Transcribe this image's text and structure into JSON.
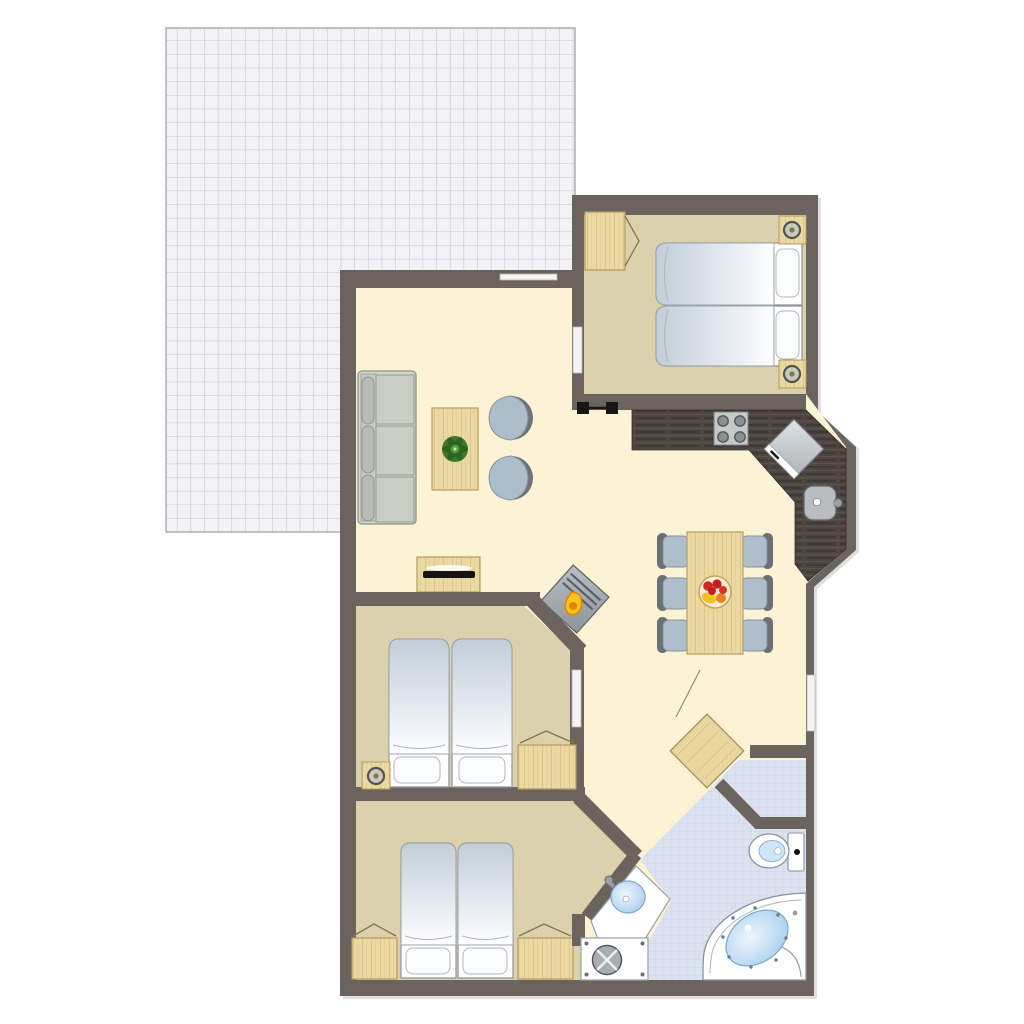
{
  "title": "Holiday apartment floor plan with terrace, three bedrooms, open living-dining-kitchen and bathroom",
  "palette": {
    "wall": "#6b635d",
    "floor_living": "#fcf2d4",
    "floor_bedroom": "#dcd1ad",
    "floor_bathroom": "#dbe3f1",
    "terrace_tile": "#f3f3f5",
    "terrace_grid": "#c2c2c9",
    "light_wood": "#ebd9a3",
    "counter_dark": "#4c4440",
    "water_blue": "#bcd9f1",
    "upholstery_gray": "#cbcec6",
    "chair_blue_gray": "#b0bfcc",
    "chair_back_gray": "#6b7075",
    "appliance_gray": "#c8ccd0",
    "flame_yellow": "#f6c41a",
    "flame_orange": "#e5830f",
    "plant_green": "#3c7a2b",
    "fruit_red": "#d02820",
    "fruit_orange": "#e8821e",
    "door_symbol_black": "#161616"
  },
  "rooms": [
    {
      "id": "terrace",
      "name": "tiled terrace",
      "floor": "gray tile grid"
    },
    {
      "id": "living-room",
      "name": "living room",
      "floor": "cream"
    },
    {
      "id": "dining-area",
      "name": "dining area",
      "floor": "cream"
    },
    {
      "id": "kitchen",
      "name": "kitchen corner with angled counter",
      "floor": "cream"
    },
    {
      "id": "bedroom-master",
      "name": "bedroom top-right (double bed)",
      "floor": "beige"
    },
    {
      "id": "bedroom-middle",
      "name": "bedroom middle-left (double bed)",
      "floor": "beige"
    },
    {
      "id": "bedroom-bottom",
      "name": "bedroom bottom-left (double bed)",
      "floor": "beige"
    },
    {
      "id": "bathroom",
      "name": "bathroom",
      "floor": "light blue tile"
    }
  ],
  "furniture": {
    "living_room": [
      "three-seat sofa",
      "coffee table",
      "potted plant",
      "lounge chair",
      "lounge chair",
      "tv sideboard",
      "wood stove"
    ],
    "dining_area": [
      "dining table",
      "6 chairs",
      "fruit bowl"
    ],
    "kitchen": [
      "L-shaped dark counter",
      "4-burner cooktop",
      "diagonal refrigerator",
      "round sink"
    ],
    "bedroom_master": [
      "double bed (2 mattresses)",
      "2 pillows",
      "2 nightstands with lamps",
      "wardrobe with open door"
    ],
    "bedroom_middle": [
      "double bed (2 mattresses)",
      "2 pillows",
      "nightstand with lamp",
      "wardrobe with open door"
    ],
    "bedroom_bottom": [
      "double bed (2 mattresses)",
      "2 pillows",
      "2 wardrobes with open doors"
    ],
    "bathroom": [
      "corner whirlpool bathtub",
      "toilet",
      "washbasin on corner counter",
      "shower tray with drain",
      "open door leaf"
    ]
  },
  "features": {
    "windows": 4,
    "sliding_door_symbols": 1,
    "open_door_leaves": 6
  }
}
